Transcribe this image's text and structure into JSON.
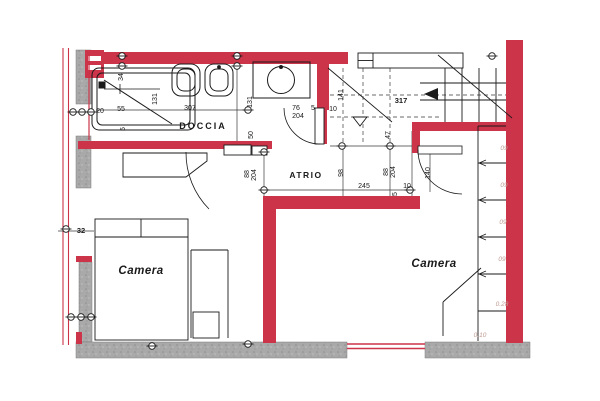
{
  "drawing": {
    "kind": "architectural floor plan (scanned, red walls)",
    "colors": {
      "wall_red": "#cb3449",
      "wall_gray": "#a8a8a8",
      "ink": "#1a1a1a",
      "faint_pencil": "#c09a92"
    }
  },
  "rooms": {
    "doccia": "DOCCIA",
    "atrio": "ATRIO",
    "camera_left": "Camera",
    "camera_right": "Camera"
  },
  "dims": {
    "d34": "34",
    "d55": "55",
    "d20": "20",
    "d5a": "5",
    "d131a": "131",
    "d307": "307",
    "d131b": "131",
    "d141": "141",
    "d76": "76",
    "d204a": "204",
    "d5b": "5",
    "d10a": "10",
    "d317": "317",
    "d47": "47",
    "d50": "50",
    "d88l": "88",
    "d204l": "204",
    "d98": "98",
    "d245": "245",
    "d88r": "88",
    "d204r": "204",
    "d140": "140",
    "d10b": "10",
    "d5c": "5",
    "d32": "32"
  },
  "notes": {
    "n09a": "09",
    "n09b": "09",
    "n09c": "09",
    "n09d": "09",
    "n028": "0.28",
    "n010": "0.10"
  }
}
